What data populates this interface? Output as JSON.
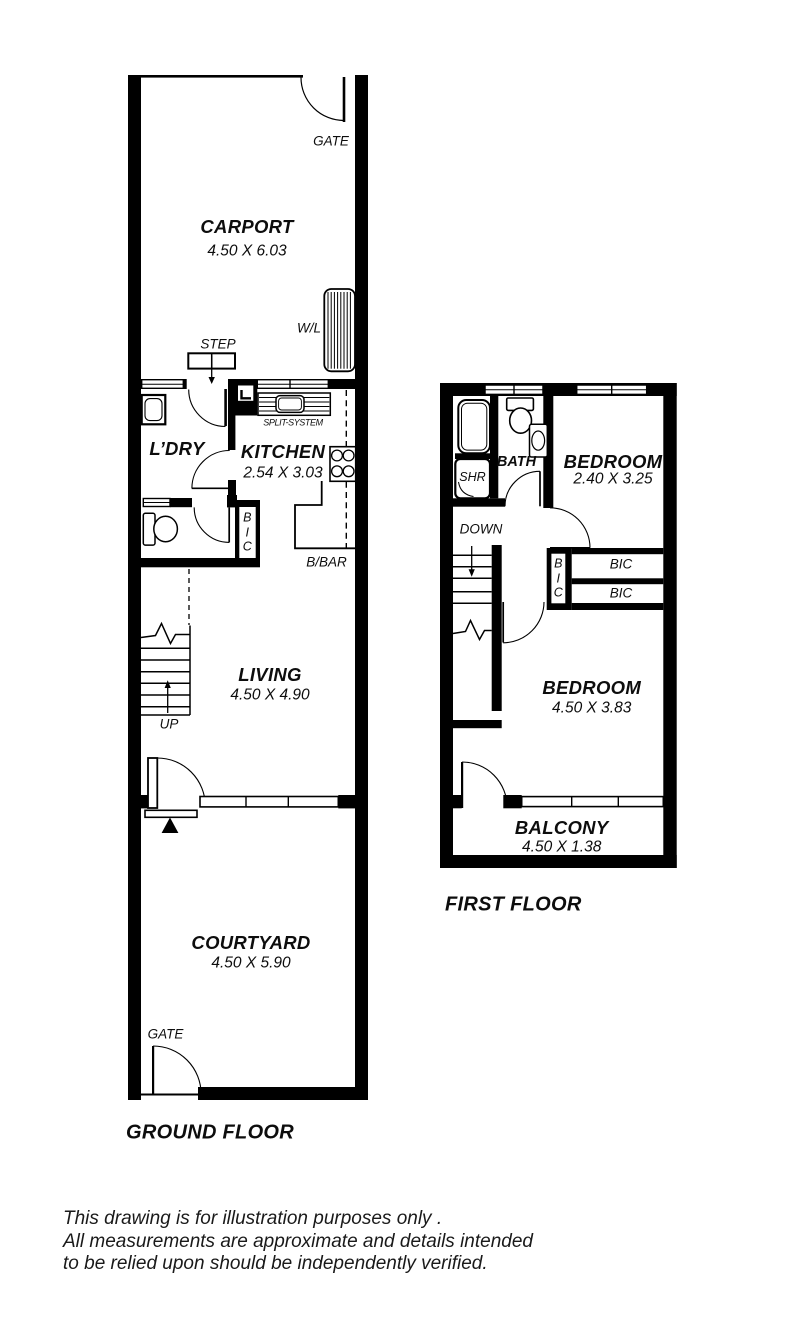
{
  "ground_floor": {
    "title": "GROUND FLOOR",
    "rooms": {
      "carport": {
        "name": "CARPORT",
        "dims": "4.50 X 6.03"
      },
      "laundry": {
        "name": "L’DRY"
      },
      "kitchen": {
        "name": "KITCHEN",
        "dims": "2.54 X 3.03"
      },
      "living": {
        "name": "LIVING",
        "dims": "4.50 X 4.90"
      },
      "courtyard": {
        "name": "COURTYARD",
        "dims": "4.50 X 5.90"
      }
    },
    "labels": {
      "gate_top": "GATE",
      "gate_bottom": "GATE",
      "step": "STEP",
      "wl": "W/L",
      "split_system": "SPLIT-SYSTEM",
      "bbar": "B/BAR",
      "bic_vertical": "B\nI\nC",
      "up": "UP"
    }
  },
  "first_floor": {
    "title": "FIRST FLOOR",
    "rooms": {
      "bath": {
        "name": "BATH"
      },
      "bedroom1": {
        "name": "BEDROOM",
        "dims": "2.40 X 3.25"
      },
      "bedroom2": {
        "name": "BEDROOM",
        "dims": "4.50 X 3.83"
      },
      "balcony": {
        "name": "BALCONY",
        "dims": "4.50 X 1.38"
      }
    },
    "labels": {
      "shr": "SHR",
      "down": "DOWN",
      "bic_vertical": "B\nI\nC",
      "bic1": "BIC",
      "bic2": "BIC"
    }
  },
  "disclaimer": {
    "lines": [
      "This drawing is for illustration purposes only .",
      "All measurements are approximate and details intended",
      "to be relied upon should be independently verified."
    ]
  },
  "colors": {
    "wall": "#000000",
    "background": "#ffffff",
    "text": "#0d0d0d"
  }
}
